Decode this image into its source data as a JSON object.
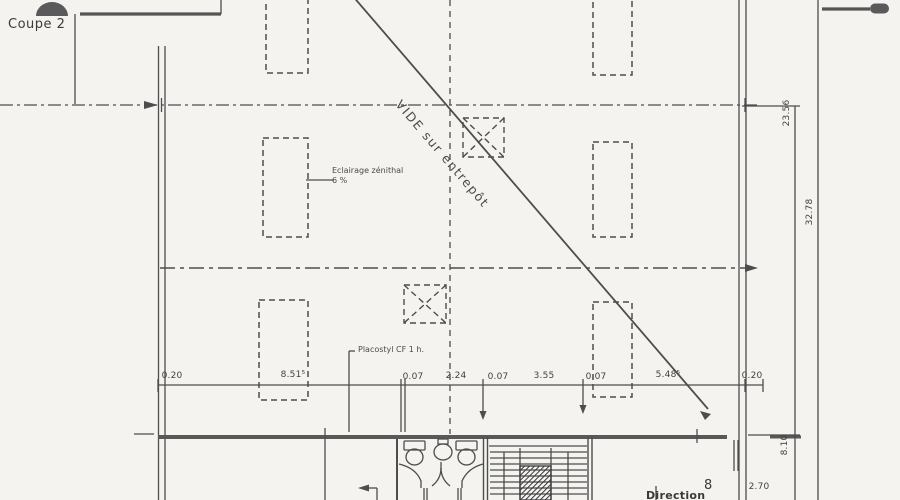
{
  "drawing": {
    "section_label": "Coupe 2",
    "void_label": "VIDE sur entrepôt",
    "skylight_note": {
      "line1": "Eclairage zénithal",
      "line2": "6 %"
    },
    "partition_note": "Placostyl CF 1 h.",
    "direction_label": "Direction",
    "door_mark": "8"
  },
  "dimensions": {
    "bottom": [
      "0.20",
      "8.51⁵",
      "0.07",
      "2.24",
      "0.07",
      "3.55",
      "0.07",
      "5.48⁵",
      "0.20"
    ],
    "right_upper": "23.56",
    "right_overall": "32.78",
    "right_lower": "8.10",
    "door_width": "2.70"
  },
  "colors": {
    "background": "#f4f3f0",
    "line": "#4d4d4d",
    "text": "#424242"
  }
}
